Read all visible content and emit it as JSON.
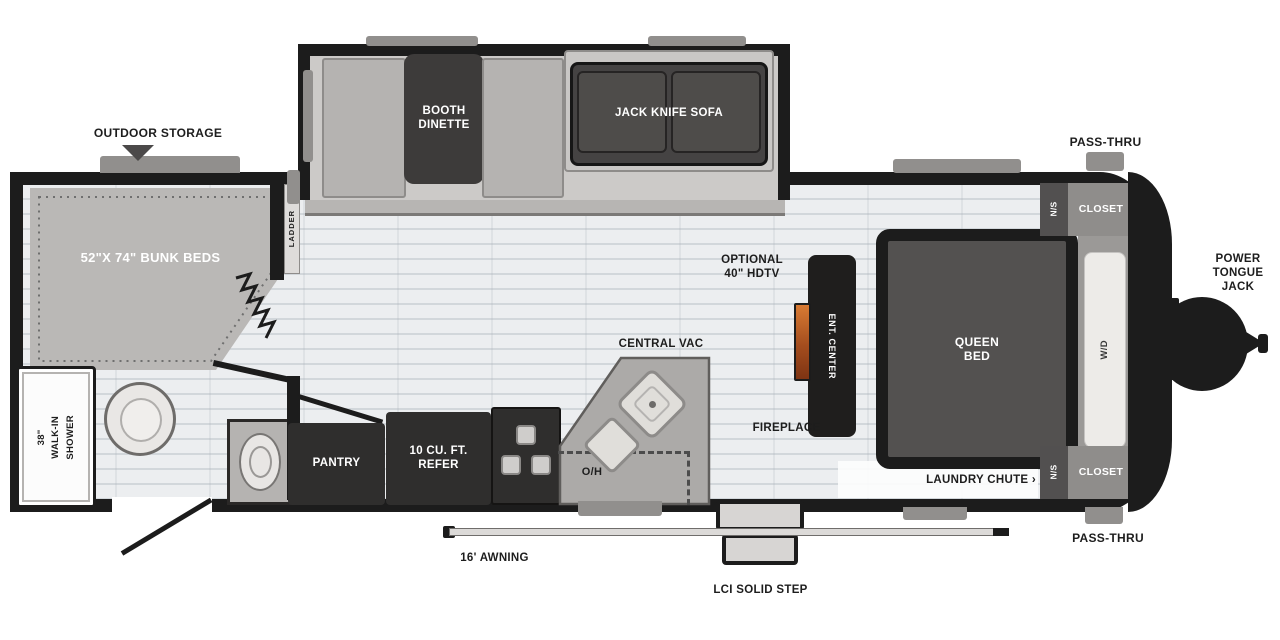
{
  "colors": {
    "wall": "#1c1c1c",
    "floor": "#eceef0",
    "slideout_floor": "#cccac8",
    "furniture_dark": "#2f2e2d",
    "fireplace_accent": "#d97b33"
  },
  "exterior": {
    "outdoor_storage": "OUTDOOR STORAGE",
    "pass_thru_top": "PASS-THRU",
    "pass_thru_bottom": "PASS-THRU",
    "power_tongue_jack": "POWER\nTONGUE\nJACK",
    "awning": "16' AWNING",
    "step": "LCI SOLID STEP"
  },
  "living": {
    "booth_dinette": "BOOTH\nDINETTE",
    "jack_knife_sofa": "JACK KNIFE SOFA",
    "bunk_beds": "52\"X 74\" BUNK BEDS",
    "ladder": "LADDER"
  },
  "kitchen": {
    "pantry": "PANTRY",
    "refer": "10 CU. FT.\nREFER",
    "overhead": "O/H",
    "central_vac": "CENTRAL VAC"
  },
  "bath": {
    "shower": "38\"\nWALK-IN\nSHOWER"
  },
  "entertainment": {
    "optional_hdtv": "OPTIONAL\n40\" HDTV",
    "ent_center": "ENT. CENTER",
    "fireplace": "FIREPLACE"
  },
  "bedroom": {
    "queen_bed": "QUEEN\nBED",
    "ns_top": "N/S",
    "ns_bottom": "N/S",
    "closet_top": "CLOSET",
    "closet_bottom": "CLOSET",
    "wd": "W/D",
    "laundry_chute": "LAUNDRY CHUTE ›"
  }
}
